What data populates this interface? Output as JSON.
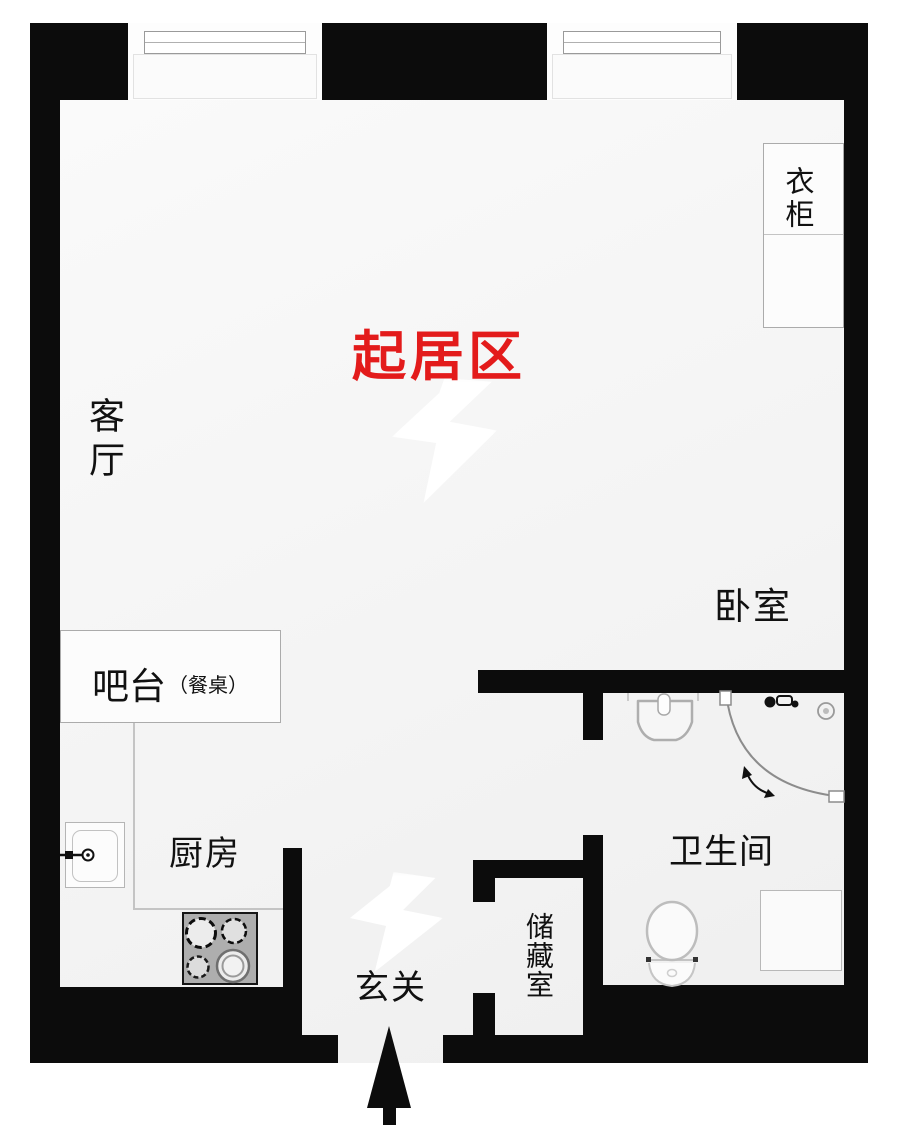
{
  "colors": {
    "wall": "#0c0c0c",
    "floor": "#f5f5f5",
    "room_label": "#111111",
    "living_area_label": "#e31b1b",
    "fixture_line": "#b5b5b5",
    "stove_fill": "#aeaeae"
  },
  "rooms": {
    "living_area": {
      "label": "起居区"
    },
    "living_room": {
      "label": "客厅"
    },
    "bedroom": {
      "label": "卧室"
    },
    "kitchen": {
      "label": "厨房"
    },
    "bathroom": {
      "label": "卫生间"
    },
    "storage": {
      "label": "储藏室"
    },
    "entry": {
      "label": "玄关"
    }
  },
  "furniture": {
    "wardrobe": {
      "label": "衣柜"
    },
    "bar_counter": {
      "label": "吧台",
      "note": "（餐桌）"
    }
  },
  "icons": {
    "entry_arrow": "up-arrow"
  }
}
